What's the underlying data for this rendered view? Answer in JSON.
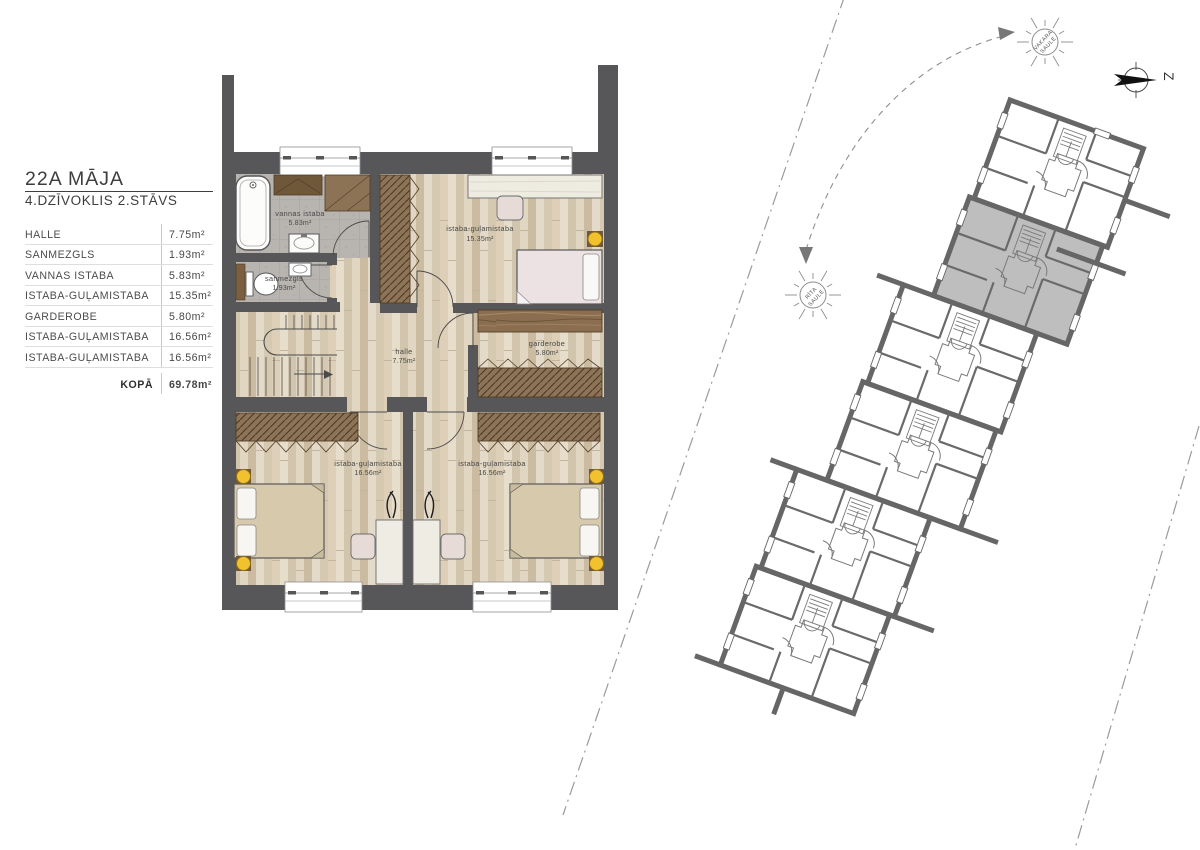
{
  "legend": {
    "title": "22A MĀJA",
    "subtitle": "4.DZĪVOKLIS 2.STĀVS",
    "rows": [
      {
        "label": "HALLE",
        "value": "7.75m²"
      },
      {
        "label": "SANMEZGLS",
        "value": "1.93m²"
      },
      {
        "label": "VANNAS ISTABA",
        "value": "5.83m²"
      },
      {
        "label": "ISTABA-GUĻAMISTABA",
        "value": "15.35m²"
      },
      {
        "label": "GARDEROBE",
        "value": "5.80m²"
      },
      {
        "label": "ISTABA-GUĻAMISTABA",
        "value": "16.56m²"
      },
      {
        "label": "ISTABA-GUĻAMISTABA",
        "value": "16.56m²"
      }
    ],
    "total_label": "KOPĀ",
    "total_value": "69.78m²"
  },
  "floor_plan": {
    "rooms": [
      {
        "name": "vannas istaba",
        "area": "5.83m²"
      },
      {
        "name": "sanmezgls",
        "area": "1.93m²"
      },
      {
        "name": "istaba-guļamistaba",
        "area": "15.35m²"
      },
      {
        "name": "halle",
        "area": "7.75m²"
      },
      {
        "name": "garderobe",
        "area": "5.80m²"
      },
      {
        "name": "istaba-guļamistaba",
        "area": "16.56m²"
      },
      {
        "name": "istaba-guļamistaba",
        "area": "16.56m²"
      }
    ]
  },
  "site_plan": {
    "street_1": "AUSTRUMU IELA",
    "street_2": "RADIOSTĀCIJAS IELA",
    "sun_evening_line1": "VAKARA",
    "sun_evening_line2": "SAULE",
    "sun_morning_line1": "RĪTA",
    "sun_morning_line2": "SAULE",
    "north_label": "Z"
  },
  "colors": {
    "wall": "#57575a",
    "site_wall": "#666666",
    "highlight_unit": "#bfbebe",
    "lamp_yellow": "#f2c12e",
    "wardrobe_brown": "#8d7457"
  }
}
